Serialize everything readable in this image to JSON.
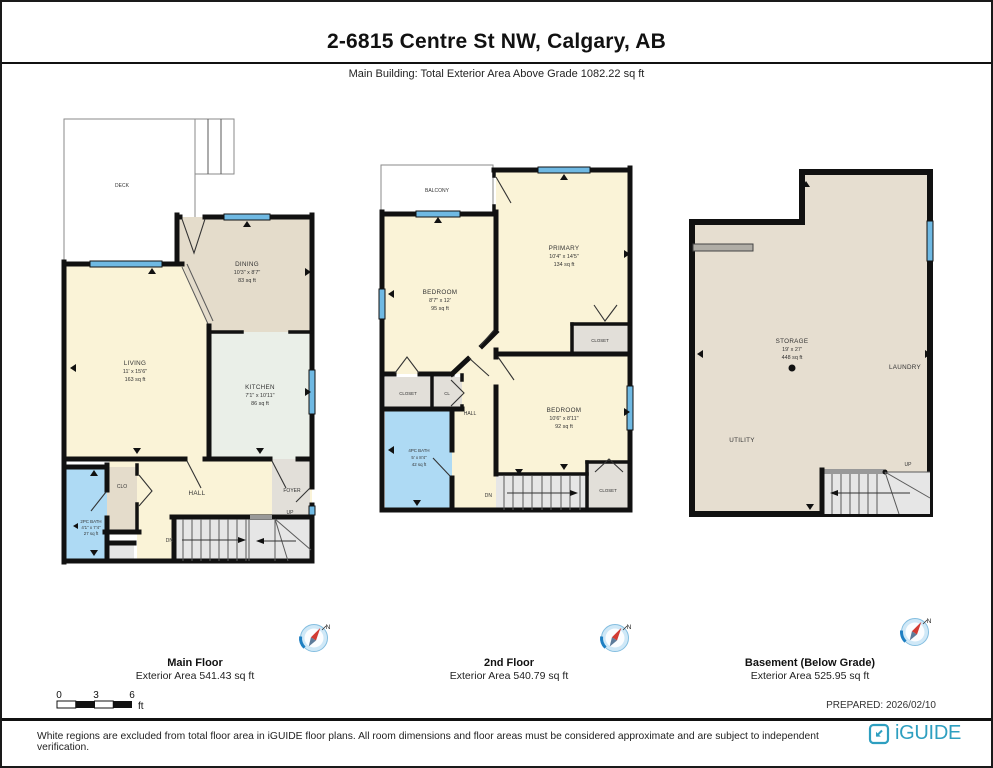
{
  "header": {
    "title": "2-6815 Centre St NW, Calgary, AB",
    "subtitle": "Main Building: Total Exterior Area Above Grade 1082.22 sq ft"
  },
  "floors": {
    "main": {
      "caption": "Main Floor",
      "caption_area": "Exterior Area 541.43 sq ft",
      "deck": "DECK",
      "dining": {
        "name": "DINING",
        "dims": "10'3\" x 8'7\"",
        "area": "83 sq ft"
      },
      "living": {
        "name": "LIVING",
        "dims": "11' x 15'6\"",
        "area": "163 sq ft"
      },
      "kitchen": {
        "name": "KITCHEN",
        "dims": "7'1\" x 10'11\"",
        "area": "86 sq ft"
      },
      "bath": {
        "name": "2PC BATH",
        "dims": "4'1\" x 7'4\"",
        "area": "27 sq ft"
      },
      "clo": "CLO",
      "hall": "HALL",
      "foyer": "FOYER",
      "up": "UP",
      "dn": "DN"
    },
    "second": {
      "caption": "2nd Floor",
      "caption_area": "Exterior Area 540.79 sq ft",
      "balcony": "BALCONY",
      "bedroom1": {
        "name": "BEDROOM",
        "dims": "8'7\" x 12'",
        "area": "95 sq ft"
      },
      "primary": {
        "name": "PRIMARY",
        "dims": "10'4\" x 14'5\"",
        "area": "134 sq ft"
      },
      "bedroom2": {
        "name": "BEDROOM",
        "dims": "10'6\" x 8'11\"",
        "area": "92 sq ft"
      },
      "bath": {
        "name": "4PC BATH",
        "dims": "5' x 8'4\"",
        "area": "42 sq ft"
      },
      "closet1": "CLOSET",
      "closet2": "CLOSET",
      "closet3": "CLOSET",
      "cl": "CL",
      "hall": "HALL",
      "dn": "DN"
    },
    "basement": {
      "caption": "Basement (Below Grade)",
      "caption_area": "Exterior Area 525.95 sq ft",
      "storage": {
        "name": "STORAGE",
        "dims": "19' x 27'",
        "area": "448 sq ft"
      },
      "utility": "UTILITY",
      "laundry": "LAUNDRY",
      "up": "UP"
    }
  },
  "compass": {
    "north": "N"
  },
  "scale_bar": {
    "t0": "0",
    "t3": "3",
    "t6": "6",
    "unit": "ft"
  },
  "prepared": "PREPARED: 2026/02/10",
  "footer": {
    "disclaimer": "White regions are excluded from total floor area in iGUIDE floor plans. All room dimensions and floor areas must be considered approximate and are subject to independent verification.",
    "brand": "iGUIDE"
  },
  "colors": {
    "wall": "#111111",
    "window_blue": "#6FB9E3",
    "room_cream": "#FAF3D7",
    "room_tan": "#E4DCCB",
    "room_mint": "#EAEFE8",
    "room_blue": "#AEDAF4",
    "room_gray": "#E2DFD9",
    "stair_gray": "#E6E6E6",
    "basement_tan": "#E6DED0",
    "brand_teal": "#2E9FC0"
  }
}
